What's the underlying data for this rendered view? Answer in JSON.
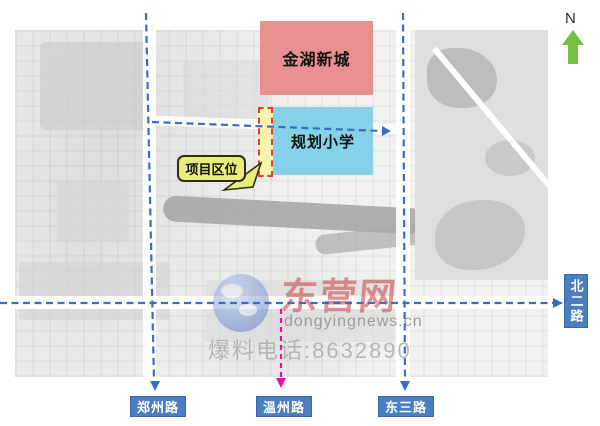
{
  "north": {
    "label": "N"
  },
  "areas": {
    "jinhu": {
      "label": "金湖新城"
    },
    "school": {
      "label": "规划小学"
    }
  },
  "callout": {
    "label": "项目区位"
  },
  "roads": {
    "zhengzhou": {
      "label": "郑州路"
    },
    "wenzhou": {
      "label": "温州路"
    },
    "dongsan": {
      "label": "东三路"
    },
    "beier": {
      "label": "北二路"
    }
  },
  "watermark": {
    "site_name": "东营网",
    "site_url": "dongyingnews.cn",
    "hotline": "爆料电话:8632890"
  },
  "colors": {
    "road_dashed_blue": "#3a6bc5",
    "road_dashed_magenta": "#e80fae",
    "area_red": "#e89090",
    "area_blue": "#85d1e8",
    "site_yellow": "#f8f3ae",
    "site_border_red": "#e03c31",
    "callout_yellow": "#e9ee78",
    "label_blue": "#4a7ec0",
    "north_green": "#76c043"
  }
}
